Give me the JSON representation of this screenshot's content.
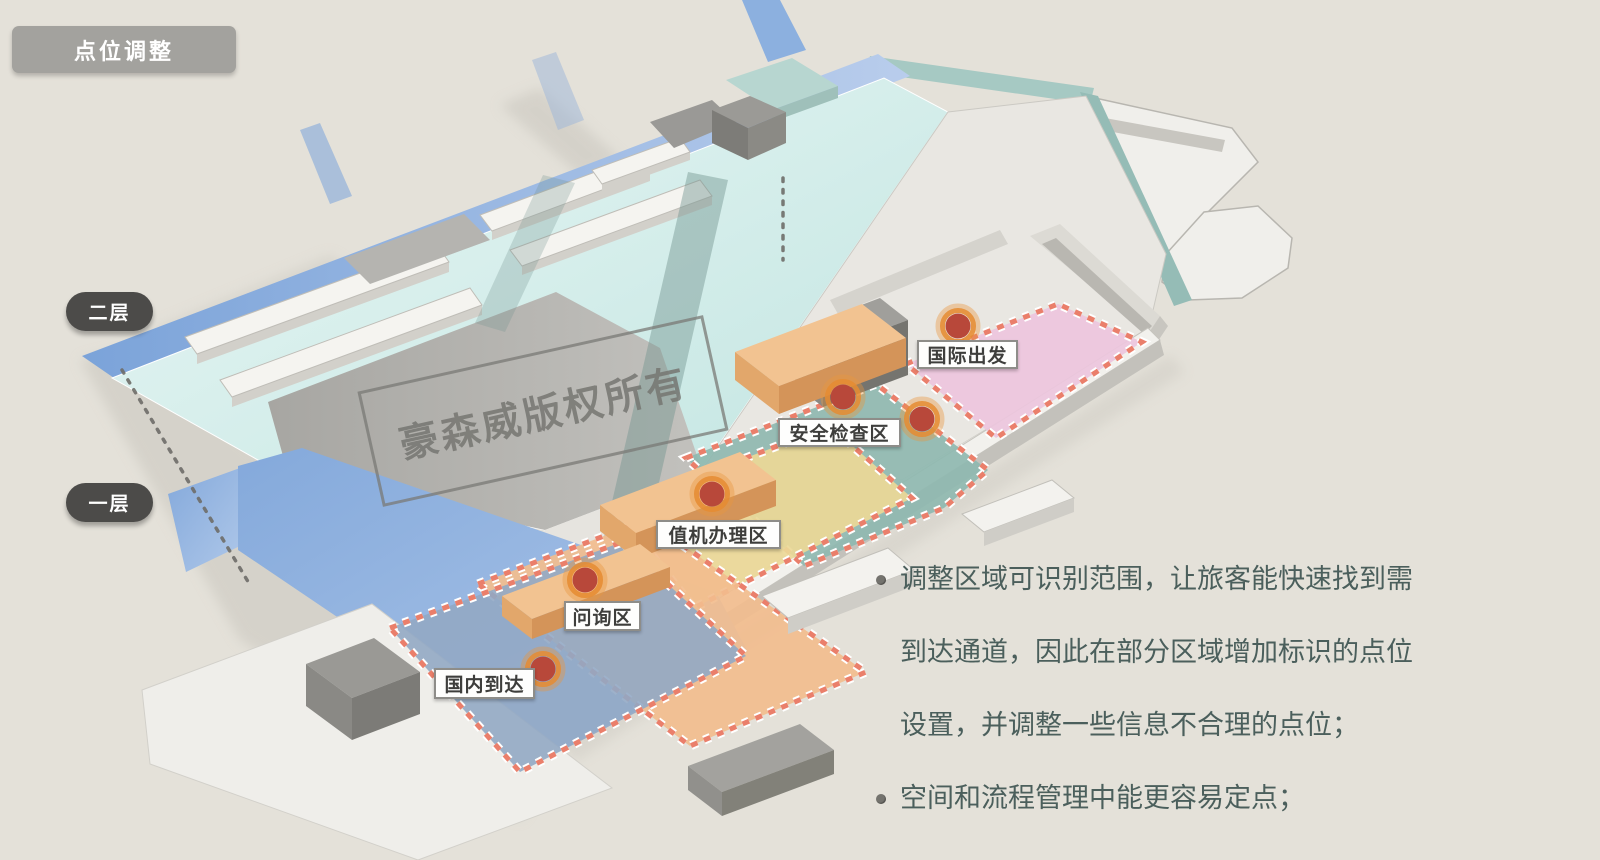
{
  "slide": {
    "title": "点位调整",
    "background_color": "#e4e1d9",
    "title_badge_color": "#a3a29e"
  },
  "floors": [
    {
      "label": "二层"
    },
    {
      "label": "一层"
    }
  ],
  "zones": [
    {
      "label": "国际出发",
      "color": "#edc6dd"
    },
    {
      "label": "安全检查区",
      "color": "#8fb8b0"
    },
    {
      "label": "值机办理区",
      "color": "#ecd897"
    },
    {
      "label": "问询区",
      "color": "#f2bd8e"
    },
    {
      "label": "国内到达",
      "color": "#92a9c4"
    }
  ],
  "markers": {
    "count": 6,
    "dot_color": "#b8483a",
    "ring_color": "#e9953f",
    "zone_border_color": "#ea7f6b"
  },
  "watermark": {
    "text": "豪森威版权所有"
  },
  "notes": {
    "text_color": "#4b5f5c",
    "bullets": [
      "调整区域可识别范围，让旅客能快速找到需到达通道，因此在部分区域增加标识的点位设置，并调整一些信息不合理的点位；",
      "空间和流程管理中能更容易定点；"
    ]
  }
}
